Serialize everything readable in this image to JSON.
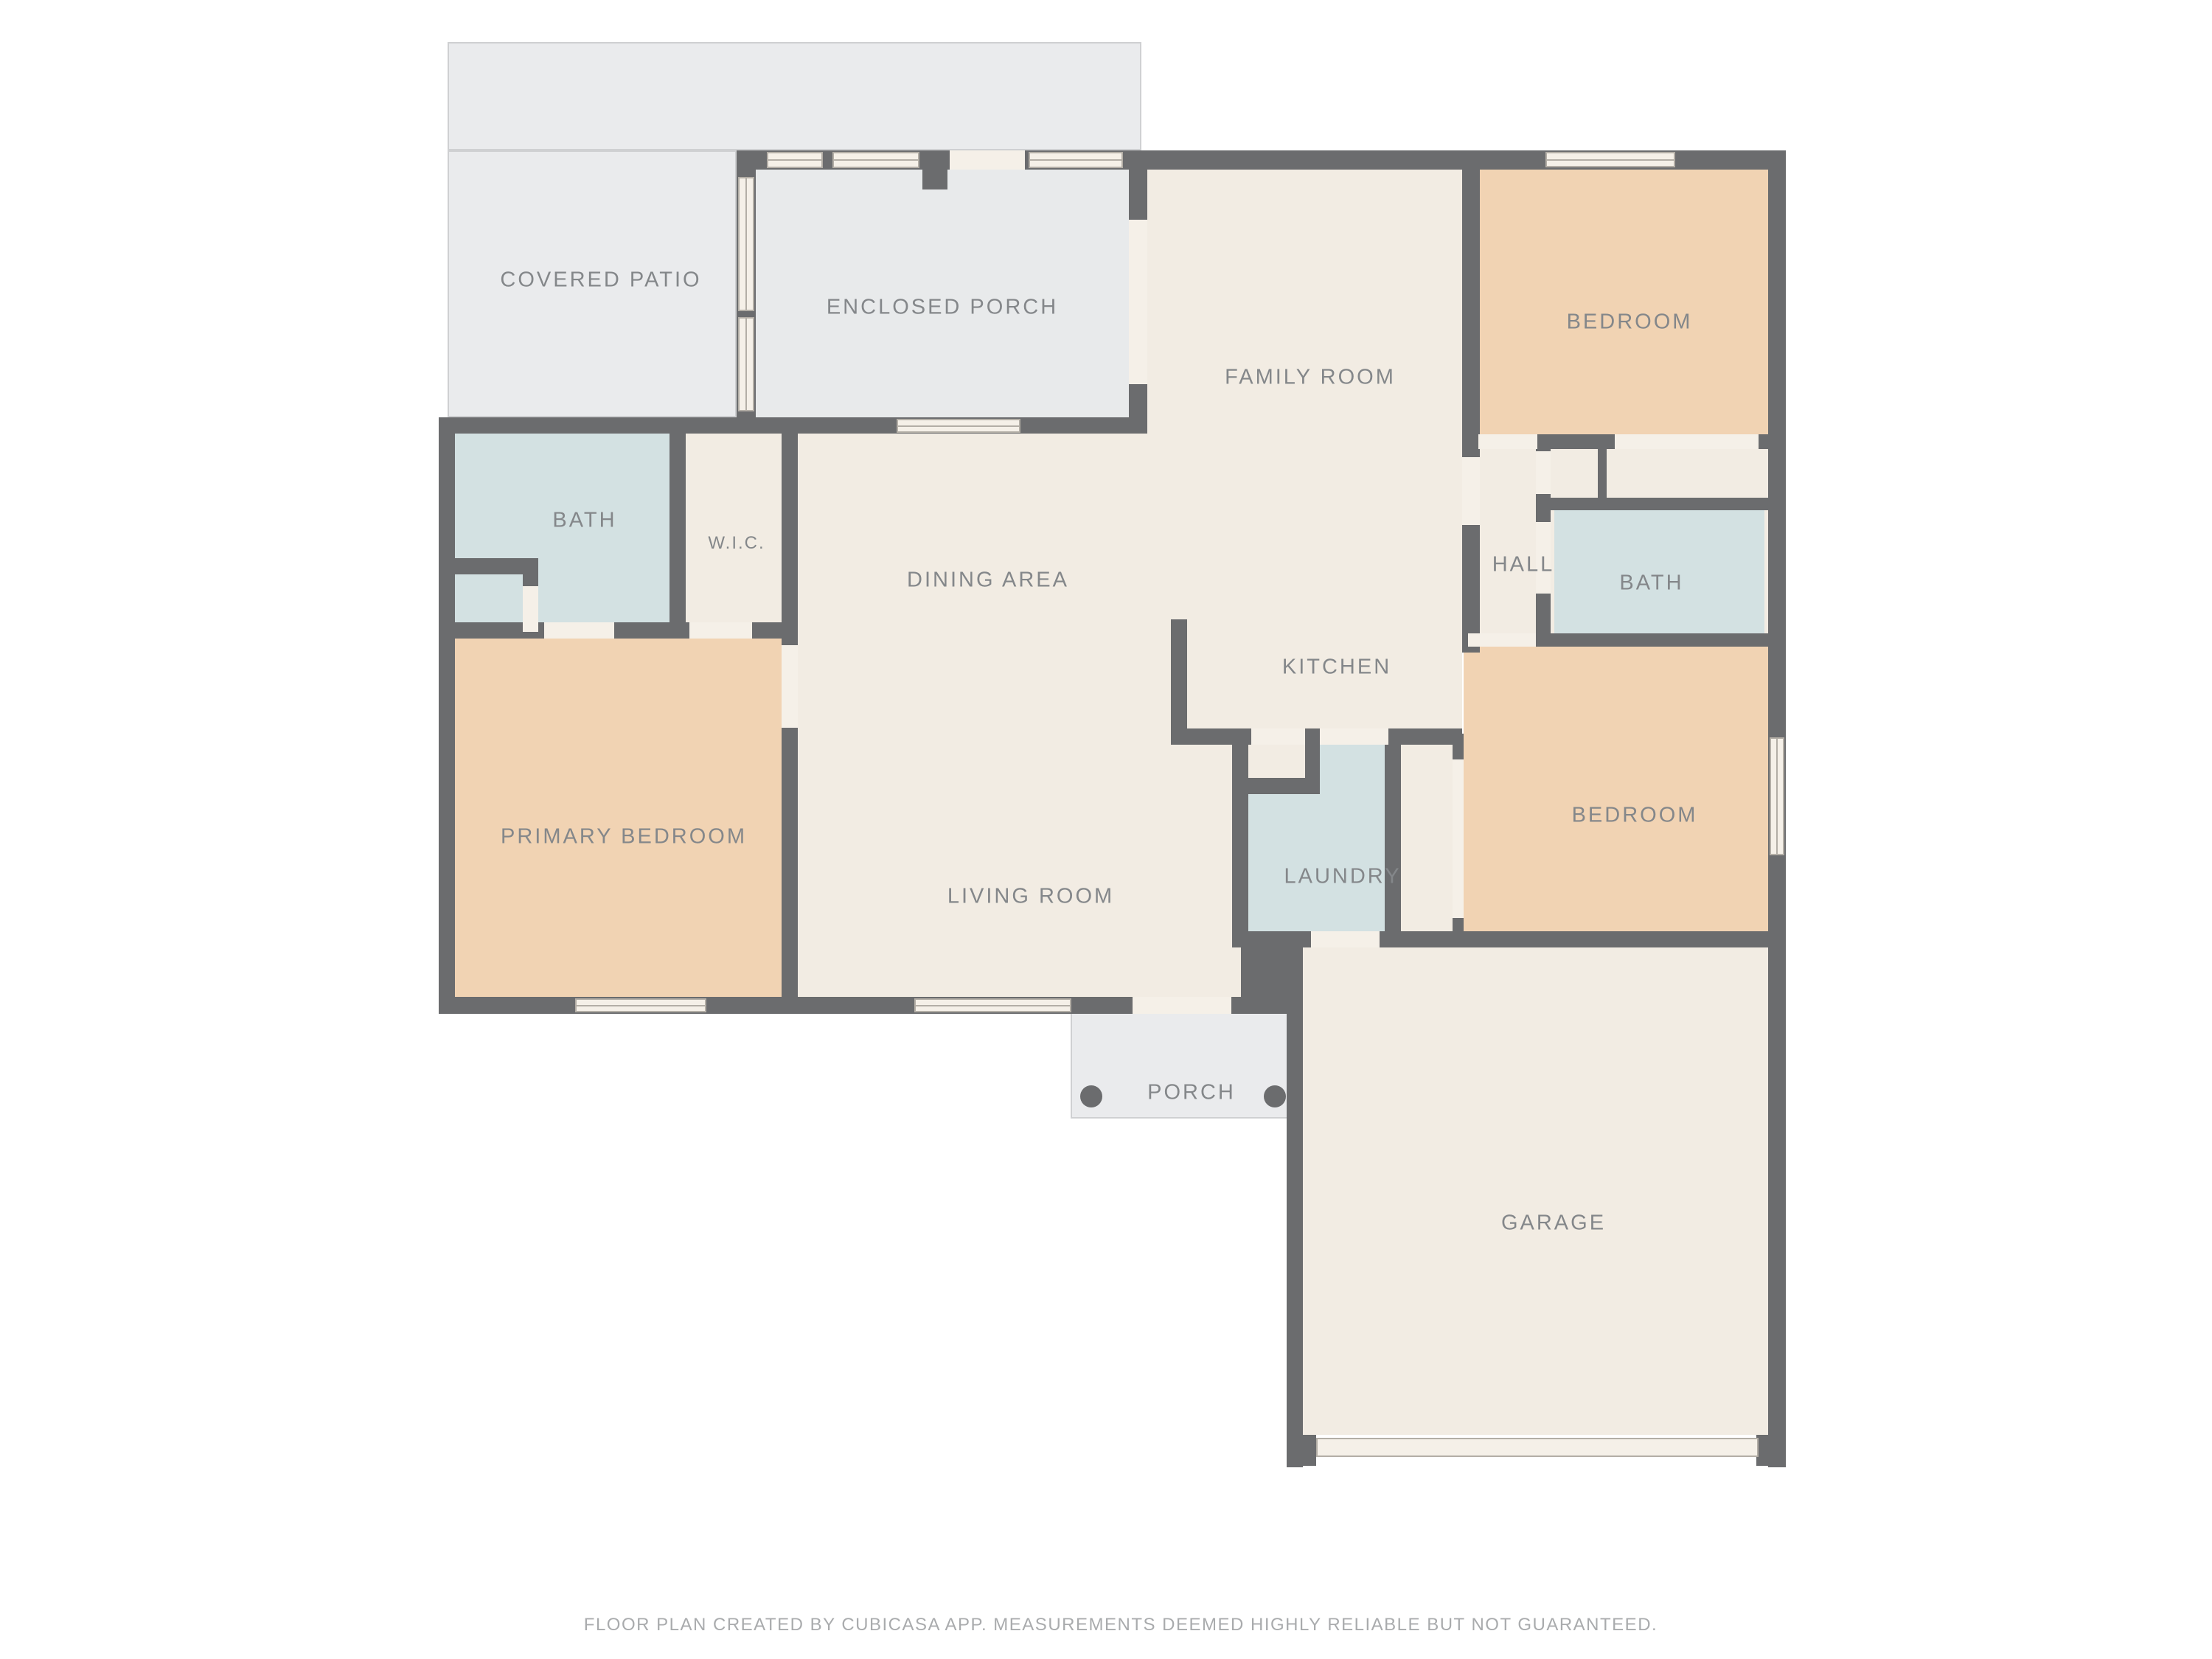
{
  "labels": {
    "covered_patio": "COVERED PATIO",
    "enclosed_porch": "ENCLOSED PORCH",
    "family_room": "FAMILY ROOM",
    "bedroom_top": "BEDROOM",
    "bath_left": "BATH",
    "wic": "W.I.C.",
    "dining_area": "DINING AREA",
    "hall": "HALL",
    "bath_right": "BATH",
    "kitchen": "KITCHEN",
    "primary_bedroom": "PRIMARY BEDROOM",
    "living_room": "LIVING ROOM",
    "laundry": "LAUNDRY",
    "bedroom_bottom": "BEDROOM",
    "porch": "PORCH",
    "garage": "GARAGE"
  },
  "footer": {
    "text": "FLOOR PLAN CREATED BY CUBICASA APP. MEASUREMENTS DEEMED HIGHLY RELIABLE BUT NOT GUARANTEED."
  },
  "colors": {
    "wall": "#6b6c6e",
    "cream": "#f2ece3",
    "peach": "#f1d3b3",
    "blue": "#d3e1e2",
    "patio": "#eaebed",
    "porchroom": "#e8eaeb",
    "door": "#f5f0e8",
    "winline": "#b3aea6",
    "outline": "#cfd0d2",
    "label": "#84878a",
    "footer": "#a9abad"
  }
}
